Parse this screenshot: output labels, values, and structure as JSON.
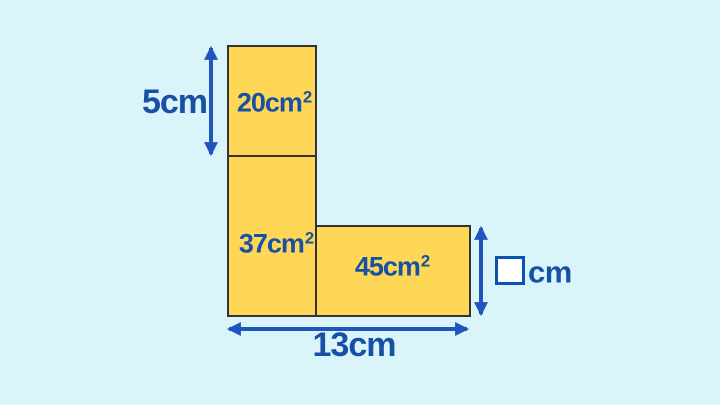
{
  "figure": {
    "type": "composite-rectangle-area-problem",
    "colors": {
      "background": "#d9f5fa",
      "shape_fill": "#fdd755",
      "shape_border": "#333333",
      "label_text": "#1850a5",
      "arrow": "#1e56bd",
      "answer_box_border": "#0d52b3",
      "answer_box_fill": "#ffffff"
    },
    "areas": {
      "top": {
        "main": "20cm",
        "sup": "2"
      },
      "left": {
        "main": "37cm",
        "sup": "2"
      },
      "right": {
        "main": "45cm",
        "sup": "2"
      }
    },
    "dimensions": {
      "left_height": "5cm",
      "bottom_width": "13cm",
      "unknown_value": "",
      "unknown_unit": "cm"
    }
  }
}
